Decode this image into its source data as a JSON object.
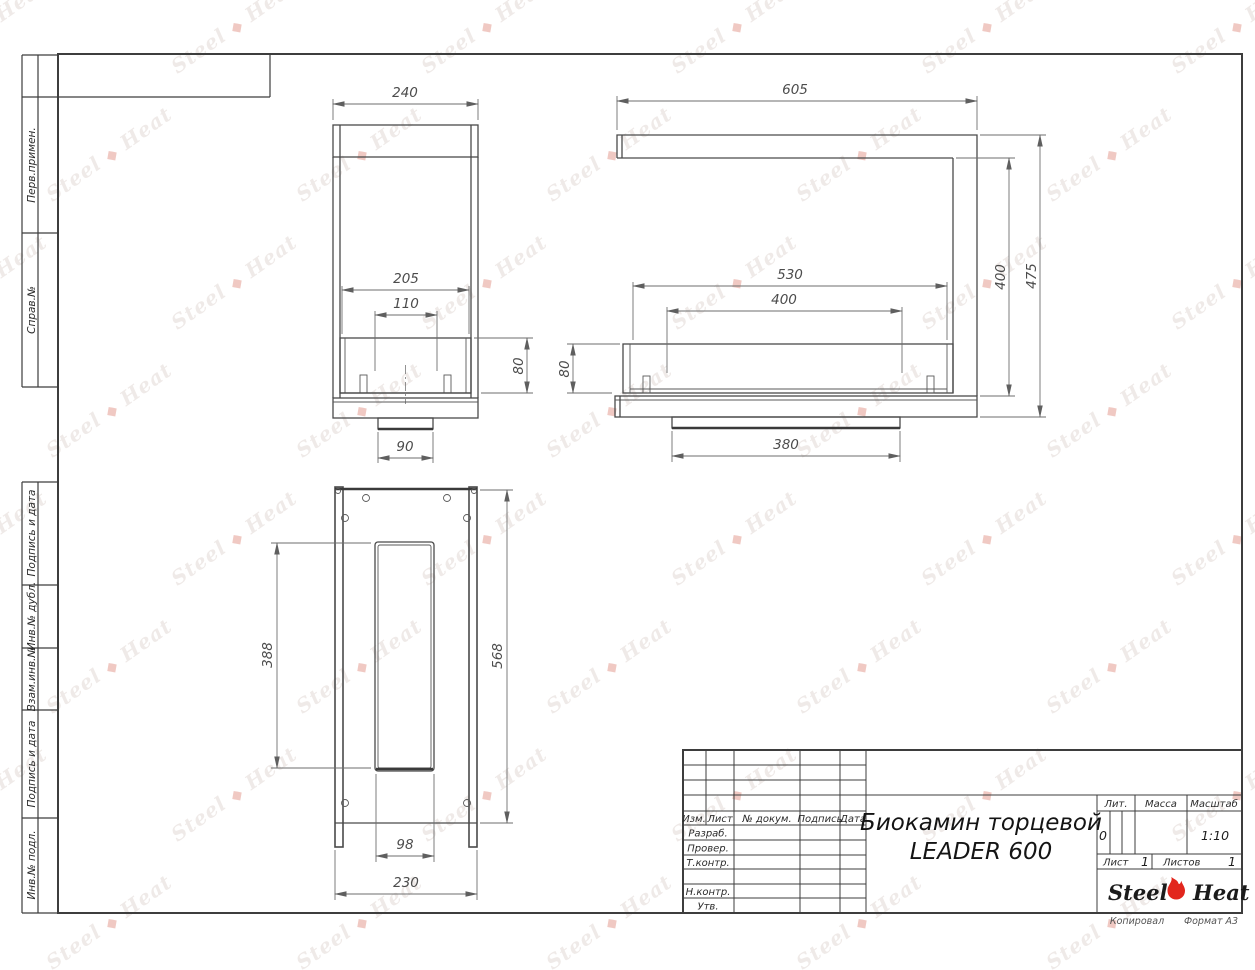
{
  "watermark": {
    "steel": "Steel",
    "mark": "◆",
    "heat": "Heat"
  },
  "margin_labels": [
    "Перв.примен.",
    "Справ.№",
    "Подпись и дата",
    "Инв.№ дубл.",
    "Взам.инв.№",
    "Подпись и дата",
    "Инв.№ подл."
  ],
  "views": {
    "side": {
      "width": "240",
      "glass_width": "205",
      "burner_width": "110",
      "glass_height": "80",
      "foot_width": "90"
    },
    "front": {
      "width": "605",
      "glass_width": "530",
      "burner_width": "400",
      "glass_height": "80",
      "inner_height": "400",
      "height": "475",
      "foot_width": "380"
    },
    "plan": {
      "slot_length": "388",
      "length": "568",
      "slot_width": "98",
      "width": "230"
    }
  },
  "title_block": {
    "cols": [
      "Изм.",
      "Лист",
      "№ докум.",
      "Подпись",
      "Дата"
    ],
    "rows": [
      "Разраб.",
      "Провер.",
      "Т.контр.",
      "Н.контр.",
      "Утв."
    ],
    "lit_label": "Лит.",
    "mass_label": "Масса",
    "scale_label": "Масштаб",
    "lit_value": "0",
    "scale_value": "1:10",
    "sheet_label": "Лист",
    "sheet_value": "1",
    "sheets_label": "Листов",
    "sheets_value": "1",
    "title_line1": "Биокамин торцевой",
    "title_line2": "LEADER 600",
    "brand_steel": "Steel",
    "brand_heat": "Heat",
    "copied": "Копировал",
    "format": "Формат А3"
  }
}
